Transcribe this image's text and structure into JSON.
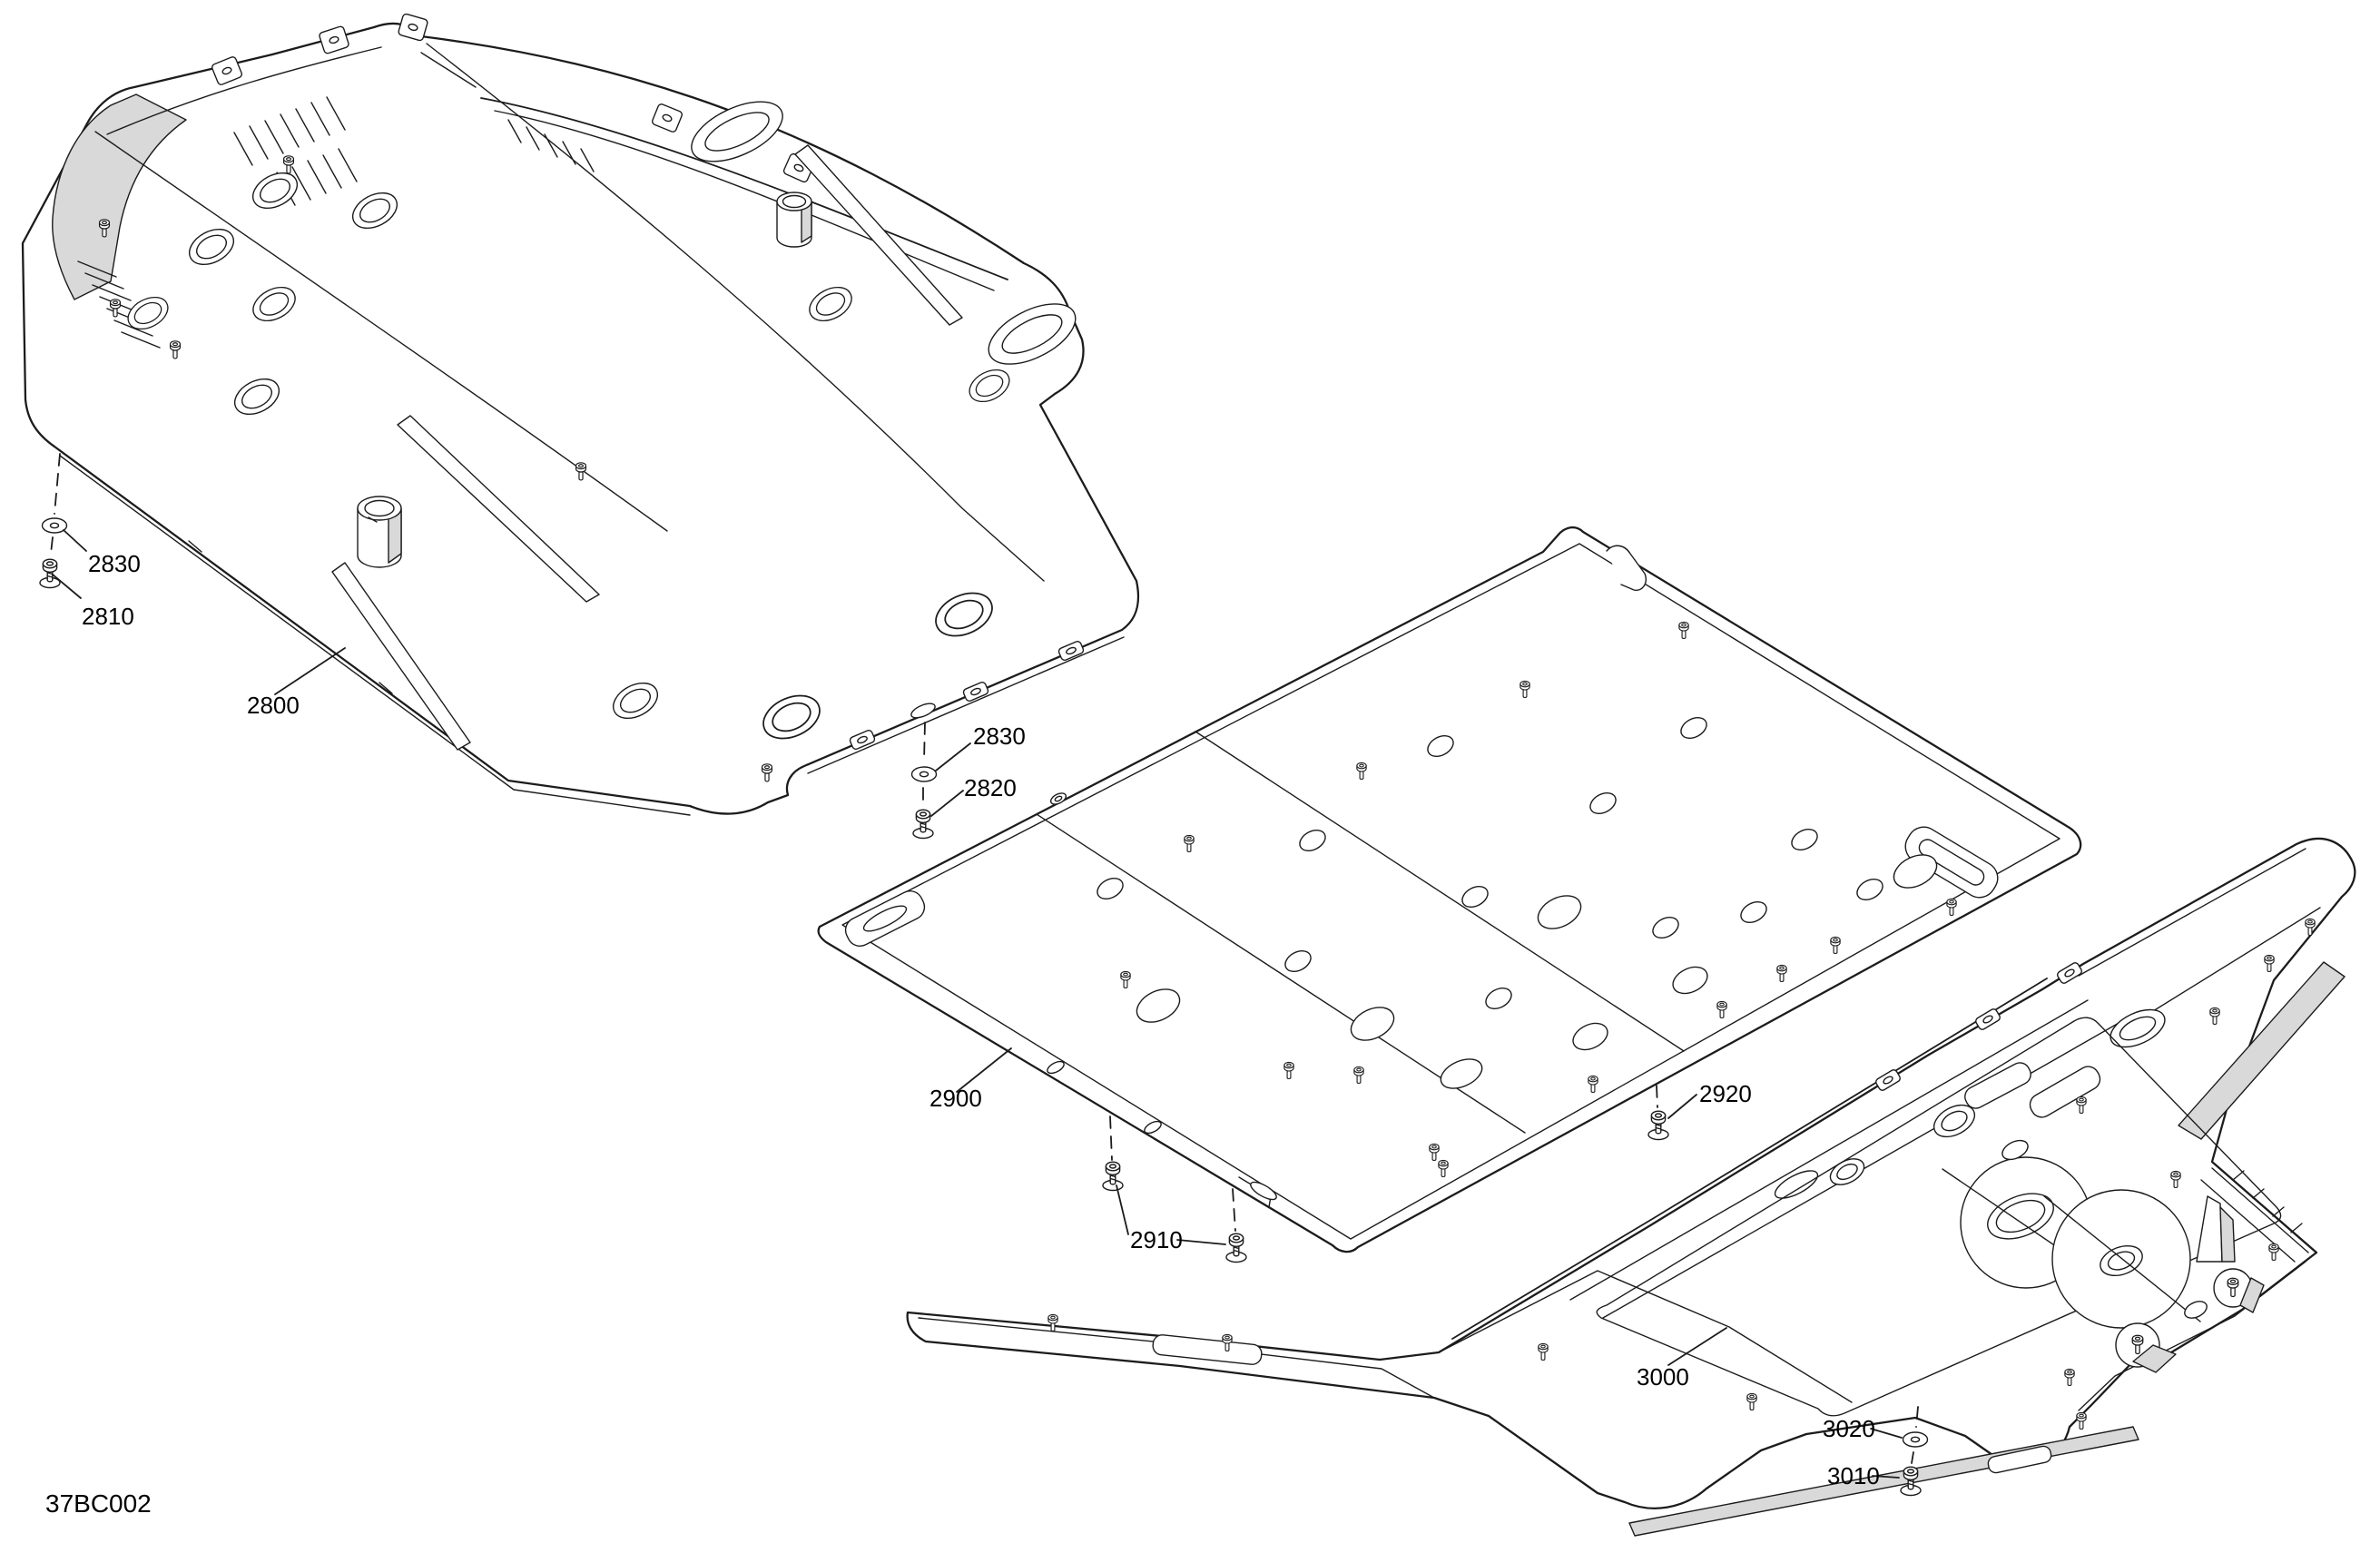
{
  "diagram": {
    "code": "37BC002",
    "callouts": {
      "front_plate": "2800",
      "front_screw": "2810",
      "front_washer": "2830",
      "center_washer": "2830",
      "center_screw": "2820",
      "center_plate": "2900",
      "center_front_screw": "2910",
      "center_rear_screw": "2920",
      "rear_plate": "3000",
      "rear_washer": "3020",
      "rear_screw": "3010"
    },
    "colors": {
      "line": "#1c1c1c",
      "shade": "#d9d9d9",
      "background": "#ffffff"
    }
  }
}
